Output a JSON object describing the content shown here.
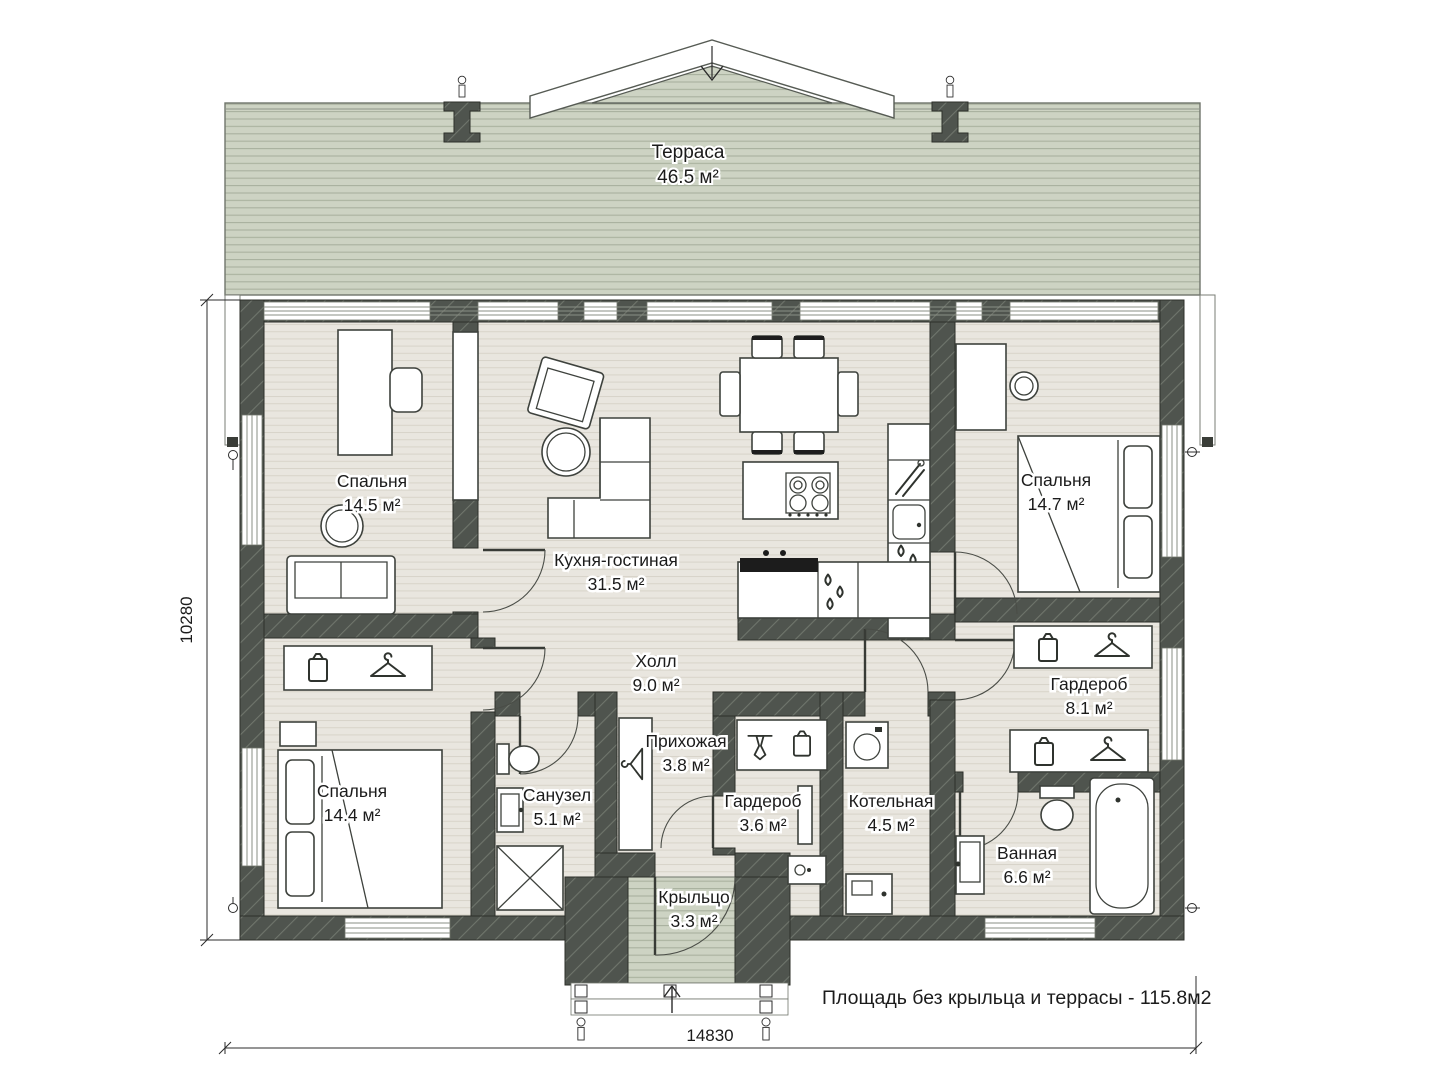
{
  "terrace": {
    "name": "Терраса",
    "area": "46.5 м²"
  },
  "rooms": [
    {
      "id": "bedroom-1",
      "name": "Спальня",
      "area": "14.5 м²"
    },
    {
      "id": "kitchen-living",
      "name": "Кухня-гостиная",
      "area": "31.5 м²"
    },
    {
      "id": "bedroom-2",
      "name": "Спальня",
      "area": "14.7 м²"
    },
    {
      "id": "hall",
      "name": "Холл",
      "area": "9.0 м²"
    },
    {
      "id": "wardrobe-big",
      "name": "Гардероб",
      "area": "8.1 м²"
    },
    {
      "id": "bedroom-3",
      "name": "Спальня",
      "area": "14.4 м²"
    },
    {
      "id": "wc",
      "name": "Санузел",
      "area": "5.1 м²"
    },
    {
      "id": "entry",
      "name": "Прихожая",
      "area": "3.8 м²"
    },
    {
      "id": "wardrobe-small",
      "name": "Гардероб",
      "area": "3.6 м²"
    },
    {
      "id": "boiler-room",
      "name": "Котельная",
      "area": "4.5 м²"
    },
    {
      "id": "bathroom",
      "name": "Ванная",
      "area": "6.6 м²"
    },
    {
      "id": "porch",
      "name": "Крыльцо",
      "area": "3.3 м²"
    }
  ],
  "dimensions": {
    "horizontal": "14830",
    "vertical": "10280"
  },
  "note": "Площадь без крыльца и террасы - 115.8м2",
  "colors": {
    "wall": "#4f544e",
    "floor": "#e9e6df",
    "deck": "#cdd3c3",
    "ink": "#1b1b1b"
  }
}
